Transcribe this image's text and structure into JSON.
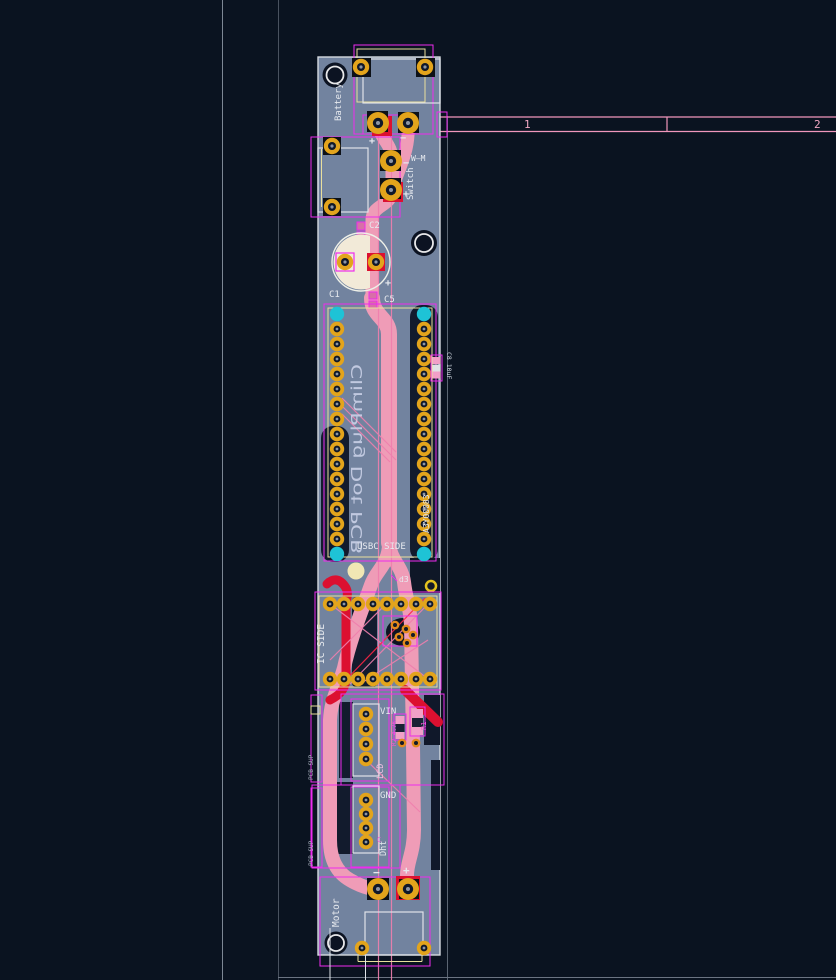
{
  "app": {
    "type": "pcb-layout-editor-canvas"
  },
  "colors": {
    "background": "#0a1320",
    "board_substrate": "#72839f",
    "copper_trace_front": "#ef9cb7",
    "copper_trace_red": "#dc1030",
    "pad_gold": "#e3a41c",
    "pad_teal": "#1ec3d6",
    "silkscreen_white": "#e7eaef",
    "footprint_outline_magenta": "#ee2bee",
    "courtyard_yellow": "#e9df9d",
    "guide_gray": "#7d8794"
  },
  "ruler": {
    "pin1": "1",
    "pin2": "2"
  },
  "components": {
    "battery": {
      "ref": "Battery",
      "plus": "+",
      "minus": "−"
    },
    "switch": {
      "ref": "Switch",
      "value": "W—M",
      "plus": "+",
      "minus": "−"
    },
    "c1": {
      "ref": "C1",
      "plus": "+"
    },
    "c2": {
      "ref": "C2"
    },
    "c5": {
      "ref": "C5"
    },
    "c8": {
      "ref": "C8 10uF"
    },
    "header": {
      "back_text": "ClimPlug Dot PCB",
      "usbc_label": "USBC SIDE",
      "serial": "A3Y00083"
    },
    "d3": {
      "ref": "d3"
    },
    "ic": {
      "label": "IC SIDE"
    },
    "lcd": {
      "pin_label": "VIN",
      "ref": "LCD"
    },
    "r2": {
      "ref": "R2 4.7K"
    },
    "r1": {
      "ref": "R1"
    },
    "dht": {
      "pin_label": "GND",
      "ref": "Dht",
      "cap_label": "C"
    },
    "motor": {
      "ref": "Motor",
      "plus": "+",
      "minus": "−"
    },
    "sup_top": {
      "ref": "PCB SUP"
    },
    "sup_bottom": {
      "ref": "PCB SUP"
    }
  }
}
